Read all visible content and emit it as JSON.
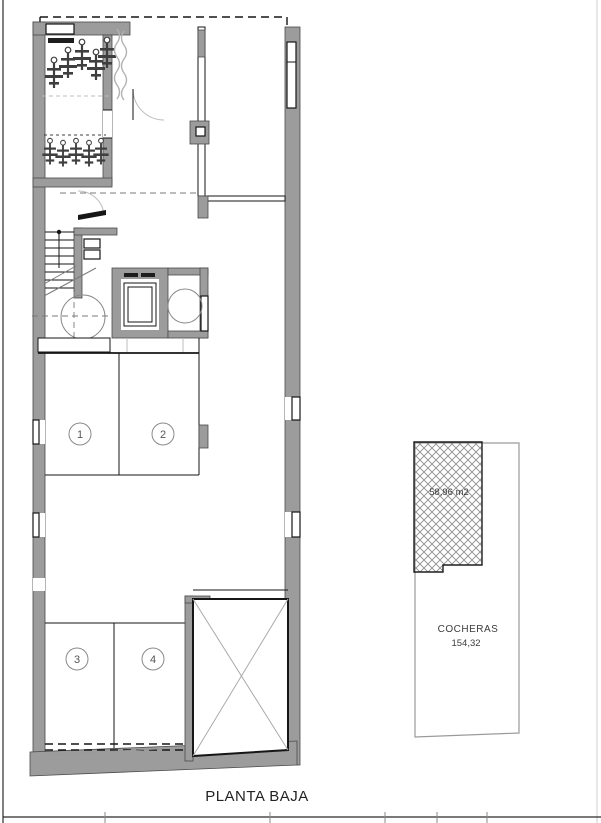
{
  "sheet": {
    "title": "PLANTA BAJA"
  },
  "plan": {
    "parking_spaces": [
      {
        "number": "1"
      },
      {
        "number": "2"
      },
      {
        "number": "3"
      },
      {
        "number": "4"
      }
    ]
  },
  "cocheras_plot": {
    "hatch_area_label": "58,96 m2",
    "name": "COCHERAS",
    "area_value": "154,32"
  },
  "colors": {
    "wall_gray": "#9c9c9c",
    "line_black": "#161616",
    "hatch_gray": "#8a8a8a",
    "light_gray": "#bdbdbd"
  }
}
